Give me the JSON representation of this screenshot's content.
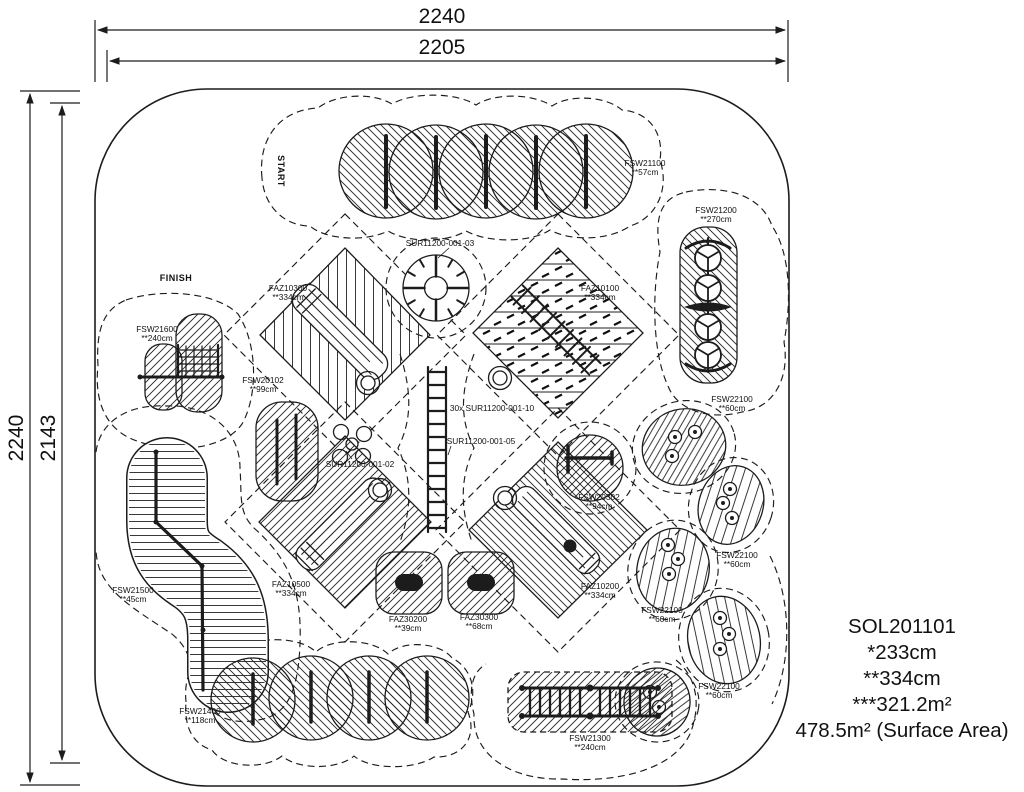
{
  "dimensions": {
    "top_outer": "2240",
    "top_inner": "2205",
    "side_outer": "2240",
    "side_inner": "2143"
  },
  "markers": {
    "start": "START",
    "finish": "FINISH"
  },
  "labels": [
    {
      "code": "FSW21100",
      "size": "**57cm"
    },
    {
      "code": "FSW21200",
      "size": "**270cm"
    },
    {
      "code": "SUR11200-001-03",
      "size": ""
    },
    {
      "code": "FAZ10300",
      "size": "**334cm"
    },
    {
      "code": "FAZ10100",
      "size": "**334cm"
    },
    {
      "code": "FSW21600",
      "size": "**240cm"
    },
    {
      "code": "FSW20102",
      "size": "**99cm"
    },
    {
      "code": "30x SUR11200-001-10",
      "size": ""
    },
    {
      "code": "SUR11200-001-05",
      "size": ""
    },
    {
      "code": "SUR11200-001-02",
      "size": ""
    },
    {
      "code": "FSW22100",
      "size": "**60cm"
    },
    {
      "code": "FSW20302",
      "size": "**94cm"
    },
    {
      "code": "FAZ10500",
      "size": "**334cm"
    },
    {
      "code": "FAZ30200",
      "size": "**39cm"
    },
    {
      "code": "FAZ30300",
      "size": "**68cm"
    },
    {
      "code": "FAZ10200",
      "size": "**334cm"
    },
    {
      "code": "FSW21500",
      "size": "**45cm"
    },
    {
      "code": "FSW22100",
      "size": "**60cm"
    },
    {
      "code": "FSW22100",
      "size": "**60cm"
    },
    {
      "code": "FSW21400",
      "size": "**118cm"
    },
    {
      "code": "FSW21300",
      "size": "**240cm"
    },
    {
      "code": "FSW22100",
      "size": "**60cm"
    }
  ],
  "summary": {
    "lines": [
      "SOL201101",
      "*233cm",
      "**334cm",
      "***321.2m²",
      "478.5m² (Surface Area)"
    ]
  }
}
